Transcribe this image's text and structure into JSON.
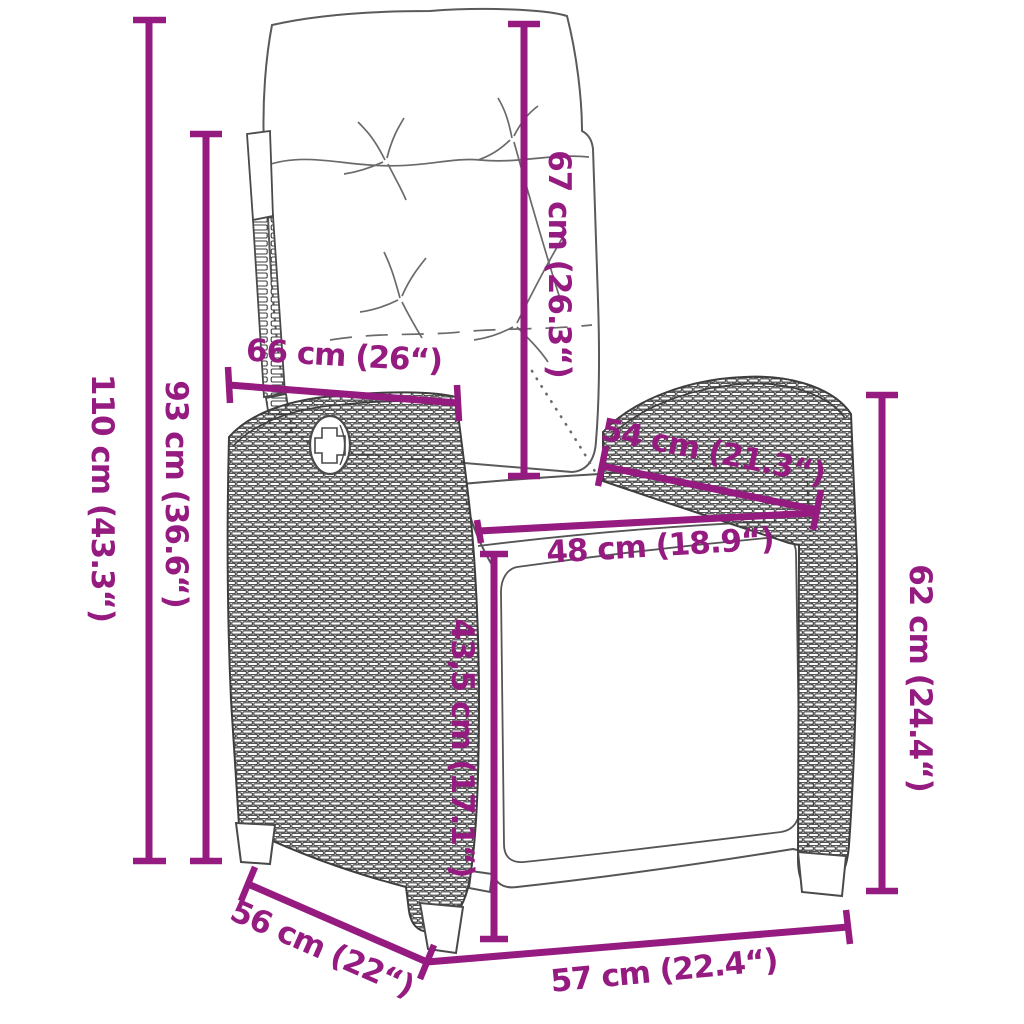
{
  "diagram": {
    "kind": "product-dimension-drawing",
    "product": "reclining rattan garden chair with cushions and footrest",
    "accent_color": "#951B81",
    "outline_color": "#4A4A4A",
    "background_color": "#FFFFFF"
  },
  "measurements": {
    "total_height": "110 cm (43.3“)",
    "back_height": "93 cm (36.6“)",
    "back_width": "66 cm (26“)",
    "back_cushion_length": "67 cm (26.3“)",
    "armrest_diagonal": "54 cm (21.3“)",
    "seat_width": "48 cm (18.9“)",
    "footrest_height": "43,5 cm (17.1“)",
    "side_height": "62 cm (24.4“)",
    "side_depth": "56 cm (22“)",
    "front_width": "57 cm (22.4“)"
  }
}
